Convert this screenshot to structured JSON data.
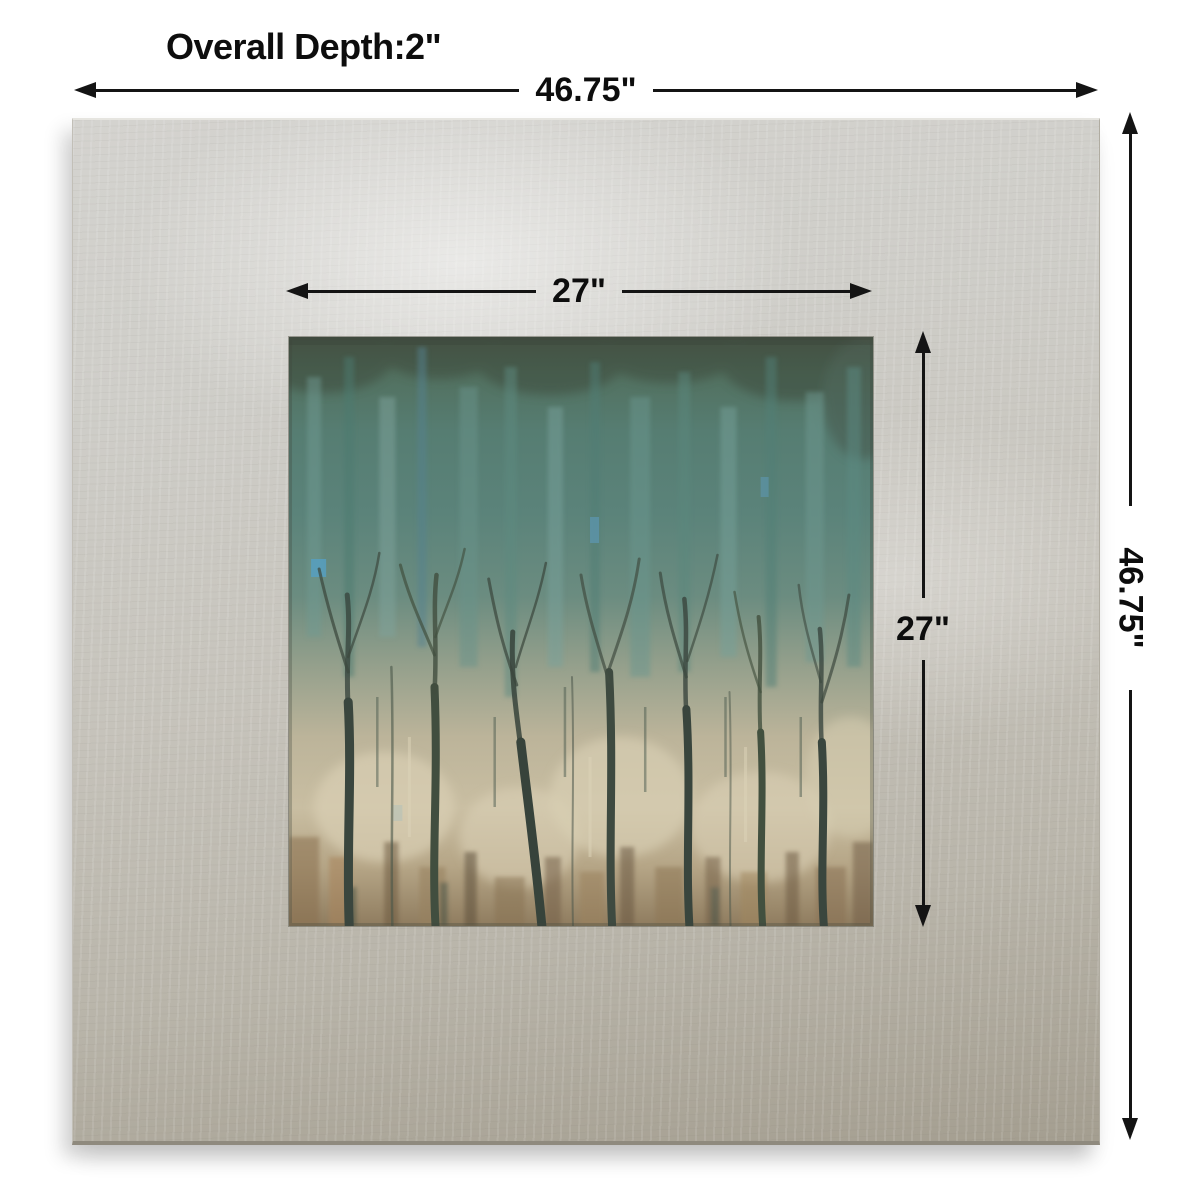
{
  "image": {
    "type": "product-dimension-diagram",
    "subject": "square silver-leaf framed abstract tree wall art"
  },
  "annotations": {
    "overall_depth_label": "Overall Depth:2\"",
    "overall_width_label": "46.75\"",
    "overall_height_label": "46.75\"",
    "artwork_width_label": "27\"",
    "artwork_height_label": "27\""
  },
  "icons": {
    "dimension_arrowheads": [
      "arrow-left-icon",
      "arrow-right-icon",
      "arrow-up-icon",
      "arrow-down-icon"
    ]
  },
  "colors": {
    "background": "#ffffff",
    "text": "#0d0d0d",
    "arrow": "#141414",
    "frameLight": "#d4d3cf",
    "frameMid": "#c6c3bb",
    "frameDark": "#a49e90",
    "canopyTeal": "#57837b",
    "canvasBeige": "#c7bca0",
    "trunkDark": "#3a463e"
  }
}
